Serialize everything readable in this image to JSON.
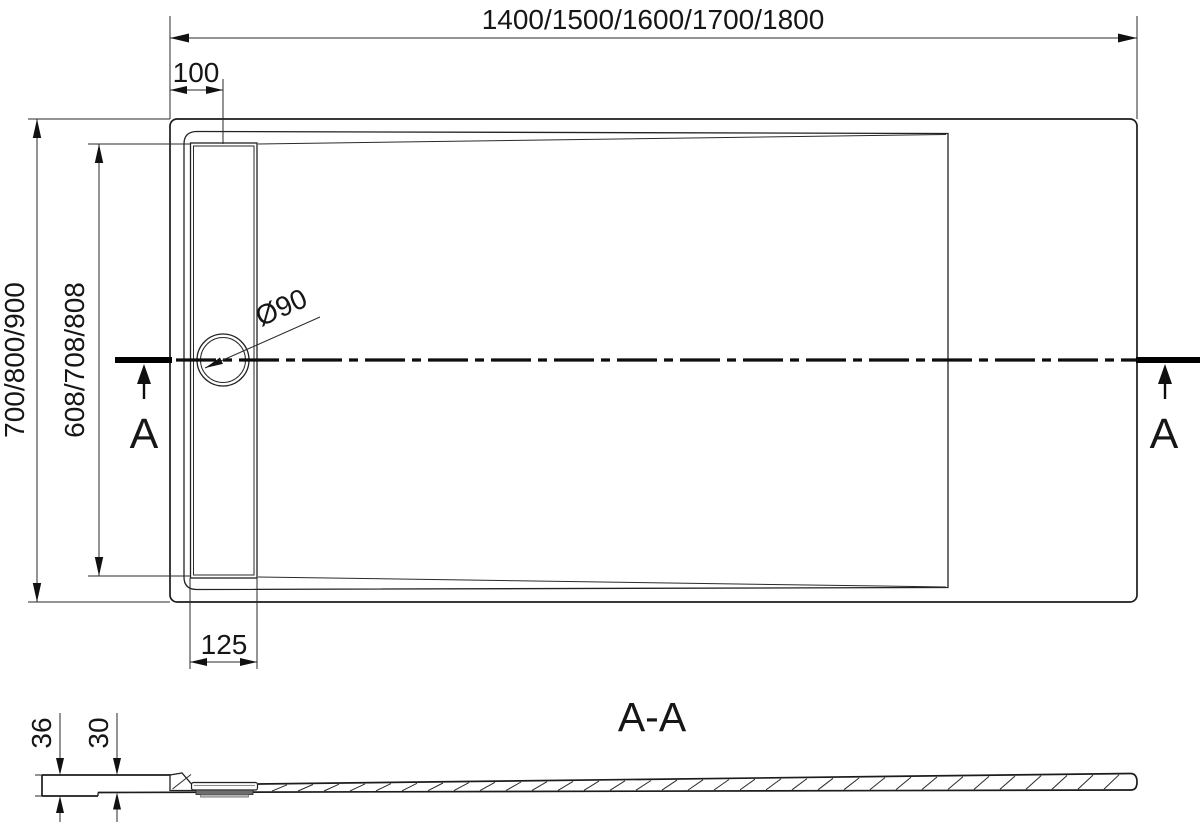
{
  "top_view": {
    "overall_width_dim": "1400/1500/1600/1700/1800",
    "drain_offset_dim": "100",
    "overall_depth_dim": "700/800/900",
    "inner_depth_dim": "608/708/808",
    "drain_diameter_label": "Ø90",
    "channel_width_dim": "125",
    "section_marker_left": "A",
    "section_marker_right": "A"
  },
  "section_view": {
    "title": "A-A",
    "edge_height_dim": "36",
    "body_height_dim": "30"
  },
  "colors": {
    "line": "#1c1c1c",
    "background": "#ffffff"
  }
}
